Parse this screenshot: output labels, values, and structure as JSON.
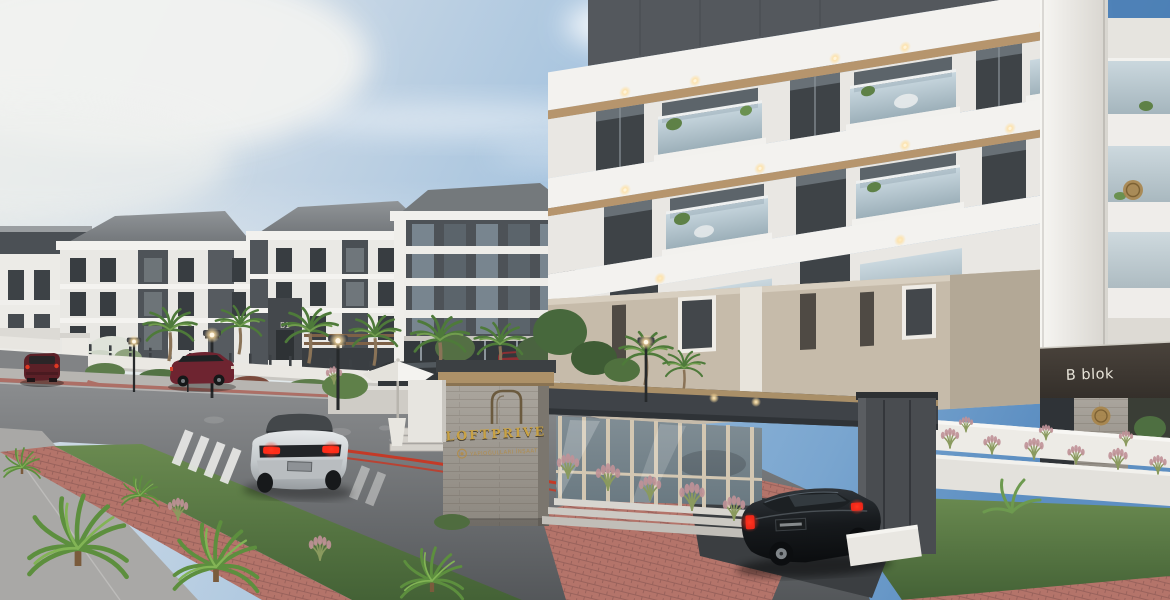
{
  "meta": {
    "scene_type": "architectural exterior render",
    "project": "LOFTPRIVE residential complex",
    "canvas": "1170x600"
  },
  "labels": {
    "entrance_sign_title": "LOFTPRIVE",
    "entrance_sign_company": "YAPIOĞULLARI İNŞAAT",
    "building_b_label": "B blok",
    "block_b1_label": "B1"
  },
  "palette": {
    "sky_deep": "#5d8fc2",
    "sky_haze": "#e6e8e4",
    "facade_white": "#efeeea",
    "facade_dark_panel": "#3e4347",
    "ground_floor_beige": "#c6bbaa",
    "roof_gray": "#7e8386",
    "canopy_bronze": "#ad9168",
    "sign_gold": "#c9a244",
    "stone": "#a7a29a",
    "asphalt": "#77797c",
    "brick_red": "#b4746a",
    "grass_green": "#5f8049",
    "taillight_red": "#e0301e"
  },
  "scene": {
    "buildings": [
      {
        "name": "left-apartment-block",
        "floors": 5,
        "label": "B1"
      },
      {
        "name": "right-apartment-block",
        "floors": 5,
        "label": "B blok"
      }
    ],
    "vehicles": [
      {
        "name": "maroon-car-far-left",
        "color": "#5c2027"
      },
      {
        "name": "maroon-suv-parked",
        "color": "#6e2430"
      },
      {
        "name": "red-car-behind-fence",
        "color": "#8d2f33"
      },
      {
        "name": "dark-sedan-terrace",
        "color": "#33373a"
      },
      {
        "name": "silver-suv-driving",
        "color": "#c9cdd0"
      },
      {
        "name": "black-sedan-entering-gate",
        "color": "#101214"
      }
    ],
    "landscape": [
      "palm-trees",
      "cycads",
      "lawn-median",
      "red-brick-path",
      "ornamental-grasses",
      "hedges"
    ],
    "street_furniture": [
      "street-lamps",
      "crosswalks",
      "patio-umbrella",
      "entrance-gate"
    ]
  }
}
